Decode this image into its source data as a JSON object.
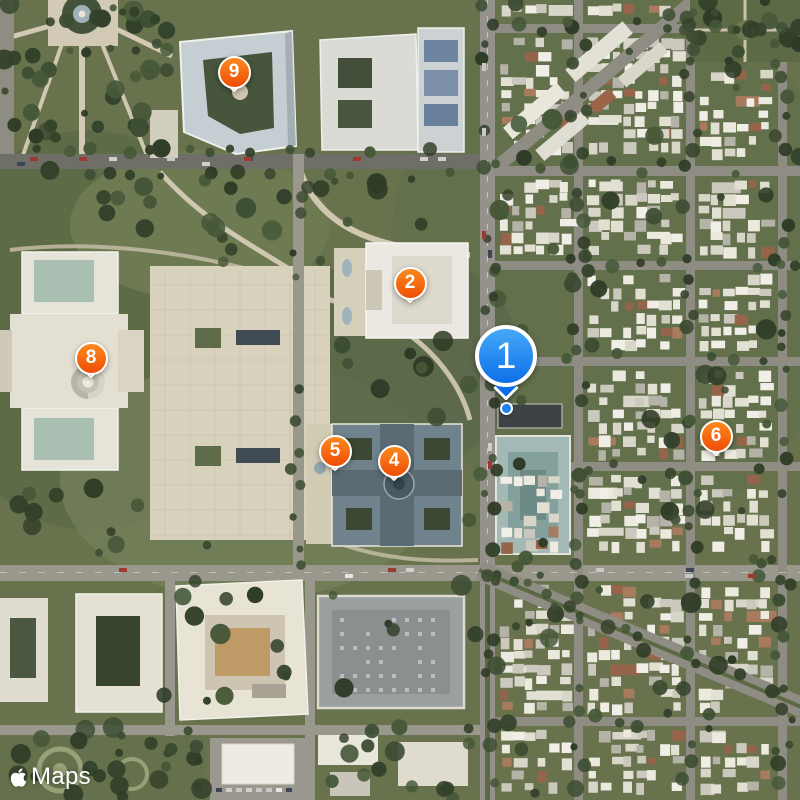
{
  "watermark": {
    "label": "Maps",
    "icon": "apple-logo-icon"
  },
  "location_dot": {
    "x": 506,
    "y": 408
  },
  "pins": [
    {
      "number": "1",
      "variant": "blue",
      "x": 506,
      "y": 401,
      "selected": true
    },
    {
      "number": "2",
      "variant": "orange",
      "x": 410,
      "y": 303,
      "selected": false
    },
    {
      "number": "4",
      "variant": "orange",
      "x": 394,
      "y": 481,
      "selected": false
    },
    {
      "number": "5",
      "variant": "orange",
      "x": 335,
      "y": 471,
      "selected": false
    },
    {
      "number": "6",
      "variant": "orange",
      "x": 716,
      "y": 456,
      "selected": false
    },
    {
      "number": "8",
      "variant": "orange",
      "x": 91,
      "y": 378,
      "selected": false
    },
    {
      "number": "9",
      "variant": "orange",
      "x": 234,
      "y": 92,
      "selected": false
    }
  ],
  "colors": {
    "pin_orange_top": "#fb8a1e",
    "pin_orange_bottom": "#ee4d05",
    "pin_blue_top": "#45a9f7",
    "pin_blue_bottom": "#0d6fe8",
    "pin_border": "#ffffff",
    "location_dot": "#1f80f2",
    "watermark_text": "#ffffff"
  }
}
